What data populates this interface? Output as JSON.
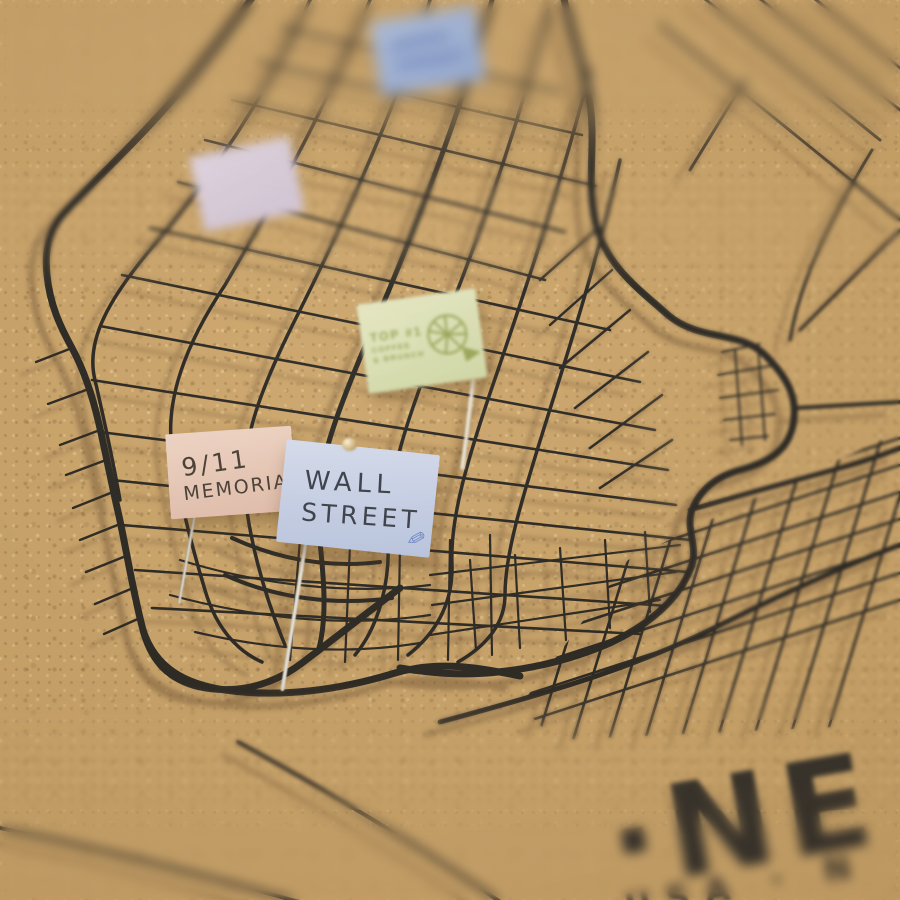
{
  "photo": {
    "subject": "Cork pinboard street map of New York (Manhattan) with paper flag pins",
    "title_text": "·NE",
    "subtitle_text": "USA · N",
    "colors": {
      "cork": "#c9a267",
      "map_lines": "#1d1c1a",
      "line_shadow": "#6e5130",
      "title_ink": "#2a2824"
    }
  },
  "flags": {
    "distant": {
      "text": "",
      "color": "#9cb4dd"
    },
    "lavender": {
      "text": "",
      "color": "#dacfe2"
    },
    "top1": {
      "line1": "TOP #1",
      "line2": "COFFEE",
      "line3": "& BRUNCH",
      "color": "#dae0b8",
      "ink": "#8f9c4e"
    },
    "memorial": {
      "line1": "9/11",
      "line2": "MEMORIAL",
      "color": "#ebcfc0",
      "ink": "#3c332b"
    },
    "wall_street": {
      "line1": "WALL",
      "line2": "STREET",
      "color": "#c6d1ec",
      "ink": "#2e3442",
      "pencil_icon": "✎"
    }
  }
}
